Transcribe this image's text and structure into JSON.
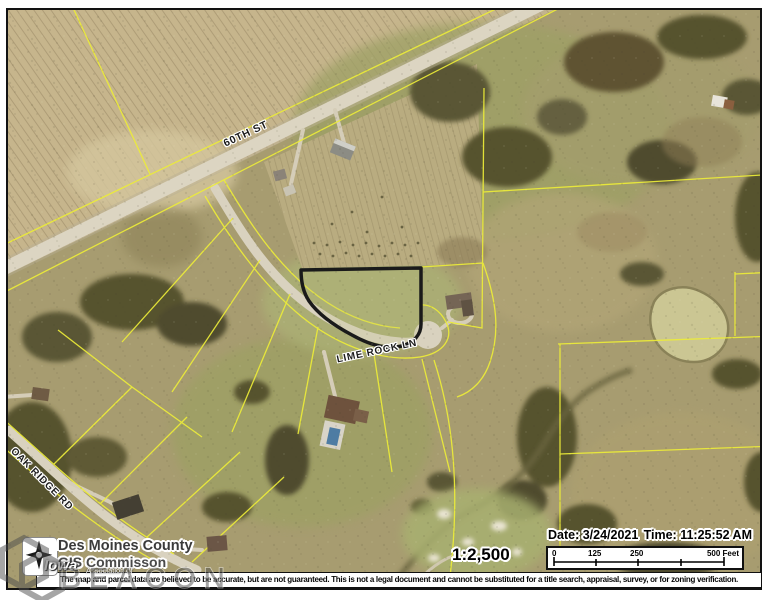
{
  "map": {
    "road_labels": {
      "road1": "60TH ST",
      "road2": "LIME ROCK LN",
      "road3": "OAK RIDGE RD"
    },
    "selected_parcel_color": "#1a1a1a",
    "parcel_line_color": "#eded38"
  },
  "footer": {
    "attribution": {
      "line1": "Des Moines County",
      "line2": "GIS Commisson",
      "state": "Iowa",
      "association": "Association of"
    },
    "scale_ratio": "1:2,500",
    "date": "Date: 3/24/2021",
    "time": "Time: 11:25:52 AM",
    "scale_bar_labels": [
      "0",
      "125",
      "250",
      "500 Feet"
    ],
    "disclaimer": "The map and parcel data are believed to be accurate, but are not guaranteed. This is not a legal document and cannot be substituted for a title search, appraisal, survey, or for zoning verification.",
    "watermark": "BEACON"
  }
}
